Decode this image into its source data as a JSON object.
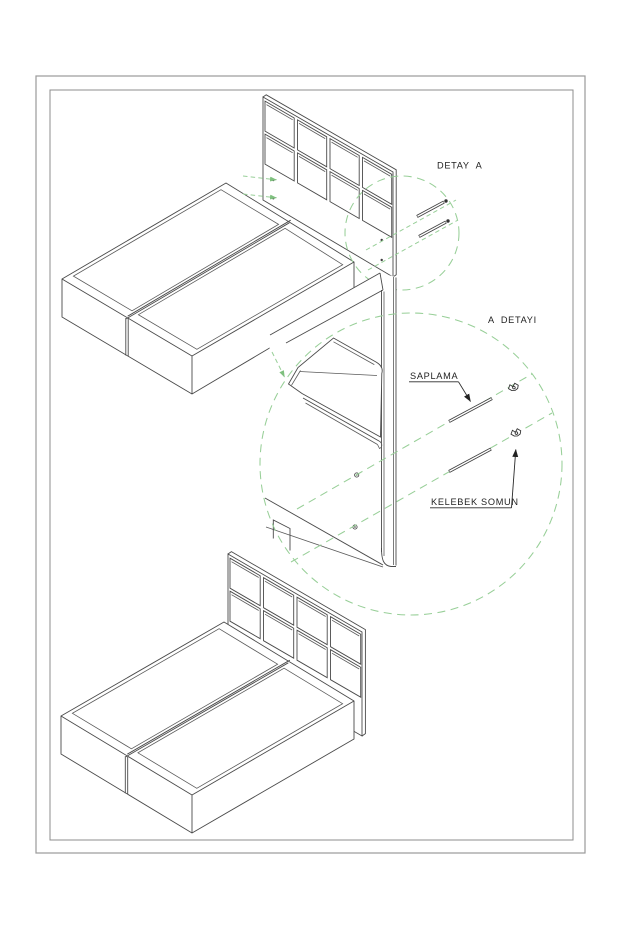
{
  "document": {
    "type": "furniture-assembly-technical-drawing",
    "labels": {
      "detail_callout": "DETAY  A",
      "detail_view_title": "A  DETAYI",
      "part_stud": "SAPLAMA",
      "part_wing_nut": "KELEBEK SOMUN"
    },
    "colors": {
      "background": "#ffffff",
      "line": "#4a4a4a",
      "detail_dash_green": "#98cf98",
      "text": "#1f1f1f",
      "border": "#9a9a9a"
    }
  }
}
